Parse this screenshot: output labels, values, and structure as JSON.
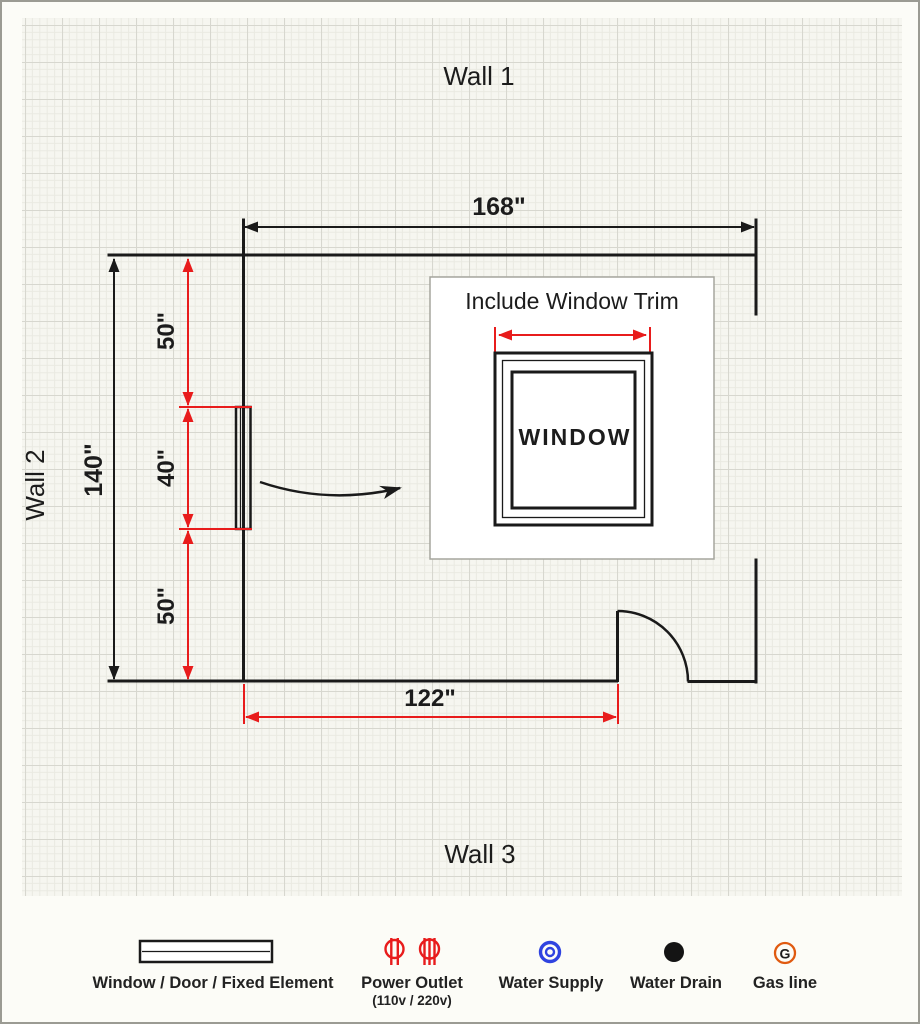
{
  "plan": {
    "wall_labels": {
      "wall1": "Wall 1",
      "wall2": "Wall 2",
      "wall3": "Wall 3"
    },
    "dimensions": {
      "top_width": "168\"",
      "left_height": "140\"",
      "left_segment_upper": "50\"",
      "left_segment_middle": "40\"",
      "left_segment_lower": "50\"",
      "bottom_to_door": "122\""
    },
    "inset": {
      "title": "Include Window Trim",
      "window_label": "WINDOW"
    }
  },
  "legend": {
    "items": [
      {
        "icon": "window-door-symbol",
        "label": "Window / Door / Fixed Element"
      },
      {
        "icon": "power-outlet-icon",
        "label": "Power Outlet",
        "sublabel": "(110v / 220v)"
      },
      {
        "icon": "water-supply-icon",
        "label": "Water Supply"
      },
      {
        "icon": "water-drain-icon",
        "label": "Water Drain"
      },
      {
        "icon": "gas-line-icon",
        "label": "Gas line"
      }
    ]
  },
  "colors": {
    "wall": "#1a1a1a",
    "dimension_red": "#e81c1c",
    "outlet_red": "#e81c1c",
    "water_supply_blue": "#2f43e0",
    "water_drain_black": "#141414",
    "gas_orange": "#e05a10",
    "text": "#1c1c1c"
  }
}
